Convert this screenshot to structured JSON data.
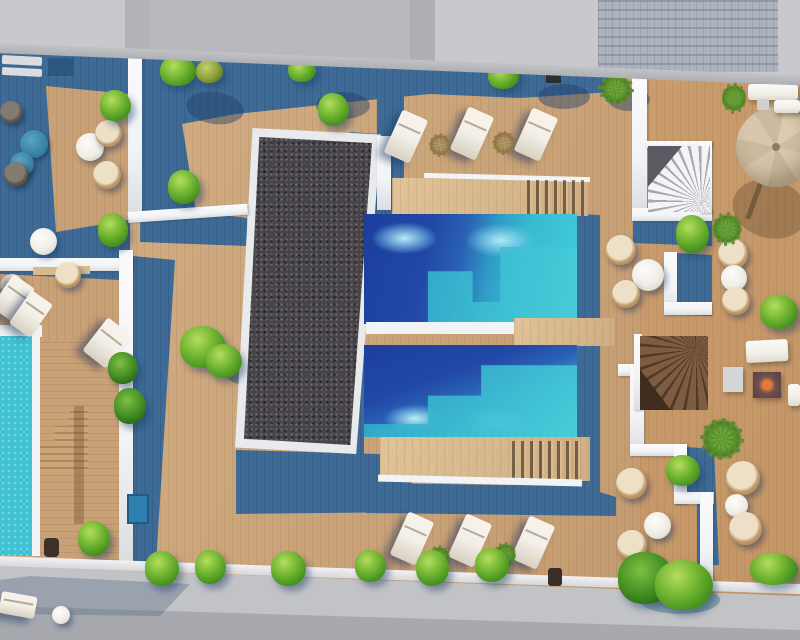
{
  "scene": {
    "description": "Aerial top-down 3D architectural rendering of a rooftop terrace complex with swimming pools, wooden decks, sun loungers, wicker furniture, a parasol, spiral staircases, a gravel bed and landscaped bushes",
    "view": "top-down aerial",
    "render_style": "photorealistic CGI"
  },
  "palette": {
    "pavement": "#c9c9cd",
    "walkway": "#c2c3c7",
    "road": "#a7a9ae",
    "building": "#b8b9bf",
    "glass-facade": "#adb2bc",
    "parapet": "#bcbdc1",
    "balustrade": "#1e3a55",
    "wood": "#c9a176",
    "wood-light": "#d9b98e",
    "shadow": "#3d6b96",
    "shadow-deep": "#2e577f",
    "wall": "#f2f3f5",
    "pool-navy": "#1d3f9e",
    "pool-mid": "#2a7fc0",
    "pool-turquoise": "#41c9d8",
    "pool-caustic": "#bef2f8",
    "left-pool": "#3fc2d3",
    "gravel": "#474449",
    "gravel-frame": "#e9eaec",
    "bush": "#6cb22f",
    "bush-light": "#b5dd5e",
    "bush-dark": "#3e8a1c",
    "bush-olive": "#8ba43c",
    "rattan": "#c09a68",
    "cushion": "#eee0c6",
    "table-white": "#f0ede6",
    "table-blue": "#2f7a9e",
    "lounger": "#f4f0e8",
    "umbrella": "#d5c3a9",
    "umbrella-seam": "#bfae93",
    "stair-light": "#d3d4d8",
    "stair-wood": "#6b4d36",
    "fire-glow": "#e07b3a",
    "sofa": "#f2efe9",
    "box-blue": "#2e7fae"
  },
  "elements": {
    "pools": {
      "count": 3,
      "labels": [
        "left lap pool",
        "upper twin pool",
        "lower twin pool"
      ]
    },
    "sun_loungers": {
      "count": 11
    },
    "wicker_chairs": {
      "count": 14
    },
    "round_tables": {
      "count": 9
    },
    "parasols": {
      "count": 1
    },
    "spiral_staircases": {
      "count": 2
    },
    "gravel_beds": {
      "count": 1
    },
    "fire_pits": {
      "count": 1
    },
    "sofas": {
      "count": 3
    },
    "bushes": {
      "count": 22
    },
    "palm_plants": {
      "count": 8
    }
  }
}
